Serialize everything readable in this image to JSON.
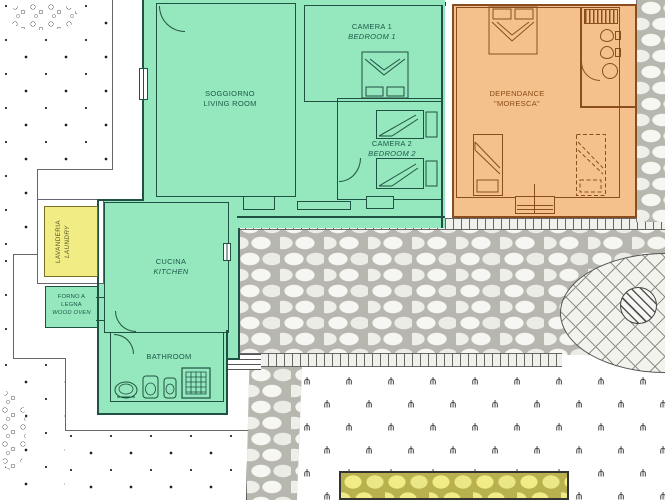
{
  "plan": {
    "rooms": {
      "soggiorno": {
        "name_it": "SOGGIORNO",
        "name_en": "LIVING ROOM"
      },
      "camera1": {
        "name_it": "CAMERA 1",
        "name_en": "BEDROOM 1"
      },
      "camera2": {
        "name_it": "CAMERA 2",
        "name_en": "BEDROOM 2"
      },
      "cucina": {
        "name_it": "CUCINA",
        "name_en": "KITCHEN"
      },
      "bathroom": {
        "name_en": "BATHROOM"
      },
      "lavanderia": {
        "name_it": "LAVANDERIA",
        "name_en": "LAUNDRY"
      },
      "forno": {
        "line1": "FORNO A",
        "line2": "LEGNA",
        "line3": "WOOD OVEN"
      },
      "dependance": {
        "line1": "DEPENDANCE",
        "line2": "\"MORESCA\""
      }
    },
    "colors": {
      "main_house_fill": "#95e7bd",
      "main_house_wall": "#1f5244",
      "dependance_fill": "#f4c18d",
      "dependance_wall": "#8a4e1e",
      "laundry_fill": "#f1ed84",
      "pavement_yellow": "#f1ec86",
      "pool_edge_blue": "#25356e"
    },
    "symbols": {
      "plant_glyph": "ψ"
    }
  }
}
